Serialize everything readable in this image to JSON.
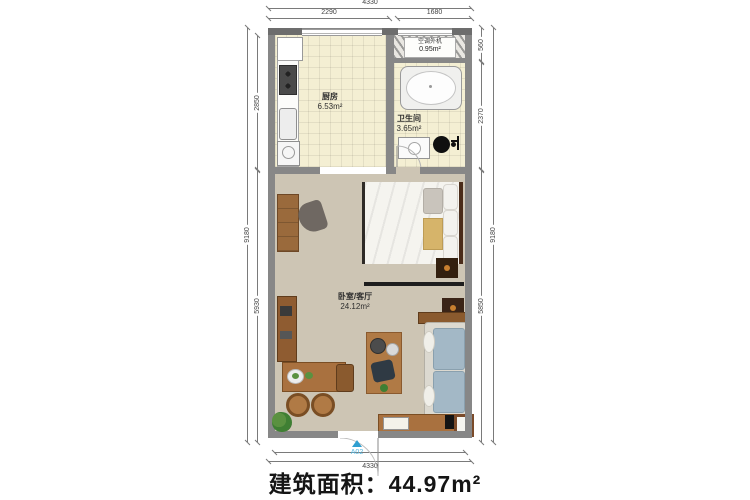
{
  "caption": "建筑面积：44.97m²",
  "dimensions": {
    "top_total": "4330",
    "top_left": "2290",
    "top_right": "1680",
    "left_outer": "9180",
    "left_upper": "2850",
    "left_lower": "5930",
    "right_upper": "560",
    "right_middle": "2370",
    "right_lower": "5850",
    "right_outer": "9180",
    "bottom_inner": "4090",
    "bottom_outer": "4330"
  },
  "rooms": {
    "kitchen": {
      "name": "厨房",
      "area": "6.53m²"
    },
    "ac_unit": {
      "name": "空调外机",
      "area": "0.95m²"
    },
    "bathroom": {
      "name": "卫生间",
      "area": "3.65m²"
    },
    "living": {
      "name": "卧室/客厅",
      "area": "24.12m²"
    }
  },
  "entry_door": {
    "label": "A02"
  },
  "colors": {
    "wall": "#878787",
    "tile_floor": "#f4efd3",
    "living_floor": "#cdc5b4",
    "wood": "#a9713f",
    "sofa": "#a3b8c6",
    "accent_blue": "#2f9fd0",
    "gold_blanket": "#d6b46a"
  }
}
